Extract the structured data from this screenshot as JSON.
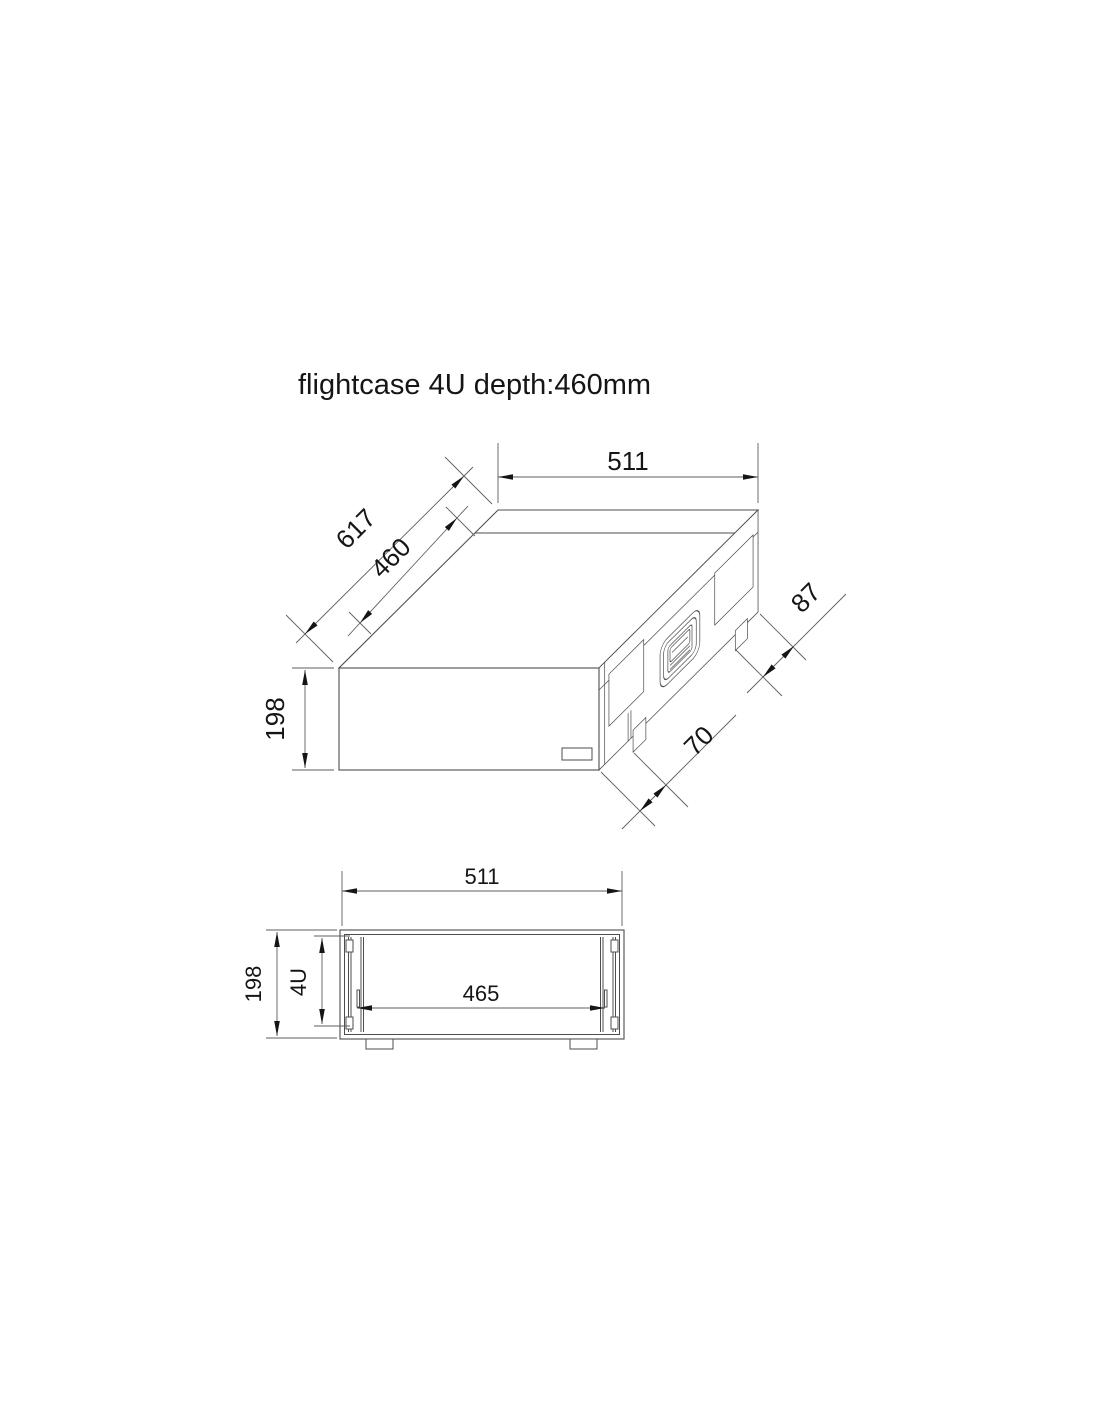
{
  "title": "flightcase 4U depth:460mm",
  "colors": {
    "background": "#ffffff",
    "geometry_line": "#4d4d4d",
    "dimension_line": "#5e5e5e",
    "text": "#151515",
    "arrow": "#151515"
  },
  "iso_view": {
    "dim_width": "511",
    "dim_outer_depth": "617",
    "dim_inner_depth": "460",
    "dim_lid": "87",
    "dim_height": "198",
    "dim_foot": "70"
  },
  "front_view": {
    "dim_width": "511",
    "dim_height": "198",
    "dim_rack_units": "4U",
    "dim_inner_width": "465"
  }
}
